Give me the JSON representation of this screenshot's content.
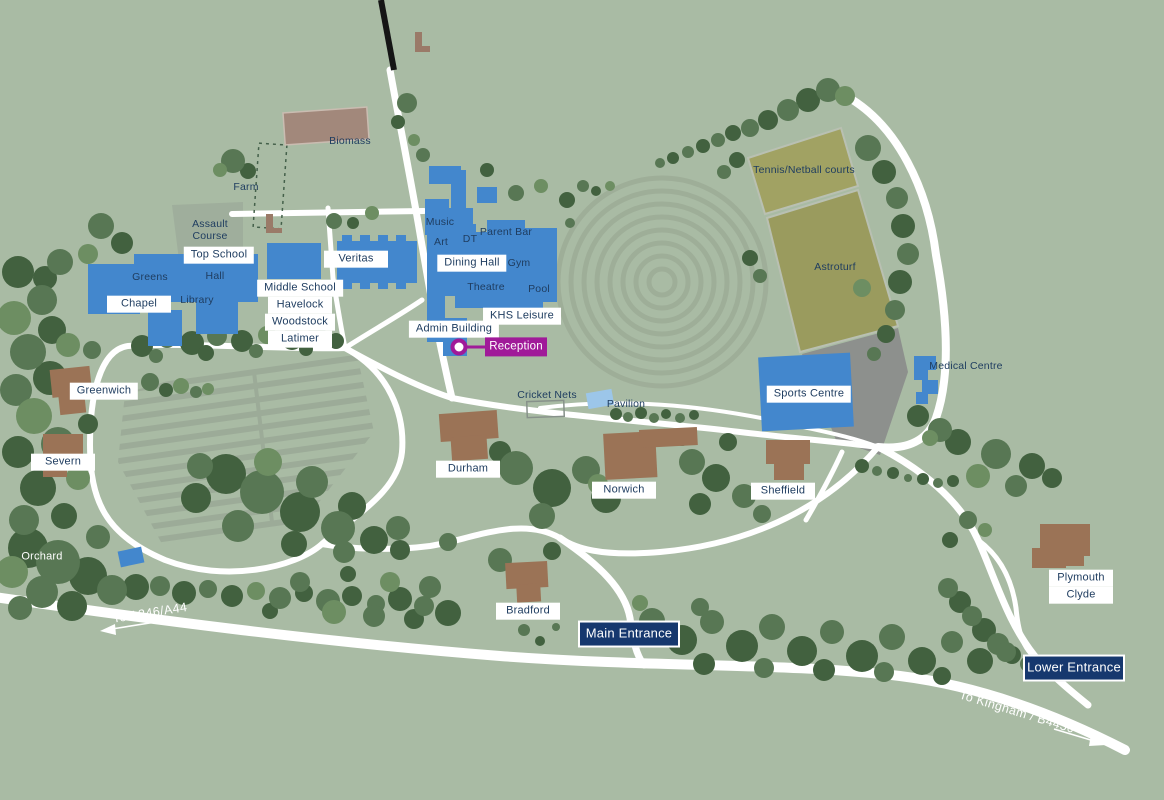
{
  "palette": {
    "background": "#a9bba4",
    "road": "#ffffff",
    "building_blue": "#4387cd",
    "building_brown": "#9b7356",
    "biomass_mauve": "#a2887b",
    "pitch_olive": "#a0a163",
    "carpark_grey": "#8d908d",
    "label_text_navy": "#1f3d60",
    "entrance_bg_navy": "#16386e",
    "reception_magenta": "#a01a99",
    "pavilion_light_blue": "#9cc6e9"
  },
  "labels": {
    "top_school": "Top School",
    "veritas": "Veritas",
    "middle_school": "Middle School",
    "havelock": "Havelock",
    "woodstock": "Woodstock",
    "latimer": "Latimer",
    "chapel": "Chapel",
    "greens": "Greens",
    "hall": "Hall",
    "library": "Library",
    "assault_course": "Assault Course",
    "farm": "Farm",
    "biomass": "Biomass",
    "music": "Music",
    "art": "Art",
    "dt": "DT",
    "parent_bar": "Parent Bar",
    "dining_hall": "Dining Hall",
    "gym": "Gym",
    "theatre": "Theatre",
    "pool": "Pool",
    "khs_leisure": "KHS Leisure",
    "admin_building": "Admin Building",
    "reception": "Reception",
    "tennis_netball": "Tennis/Netball courts",
    "astroturf": "Astroturf",
    "sports_centre": "Sports Centre",
    "medical_centre": "Medical Centre",
    "cricket_nets": "Cricket Nets",
    "pavilion": "Pavilion",
    "greenwich": "Greenwich",
    "severn": "Severn",
    "orchard": "Orchard",
    "durham": "Durham",
    "norwich": "Norwich",
    "sheffield": "Sheffield",
    "bradford": "Bradford",
    "plymouth": "Plymouth",
    "clyde": "Clyde",
    "main_entrance": "Main Entrance",
    "lower_entrance": "Lower Entrance",
    "to_a346": "To A346/A44",
    "to_kingham": "To Kingham / B4450"
  }
}
